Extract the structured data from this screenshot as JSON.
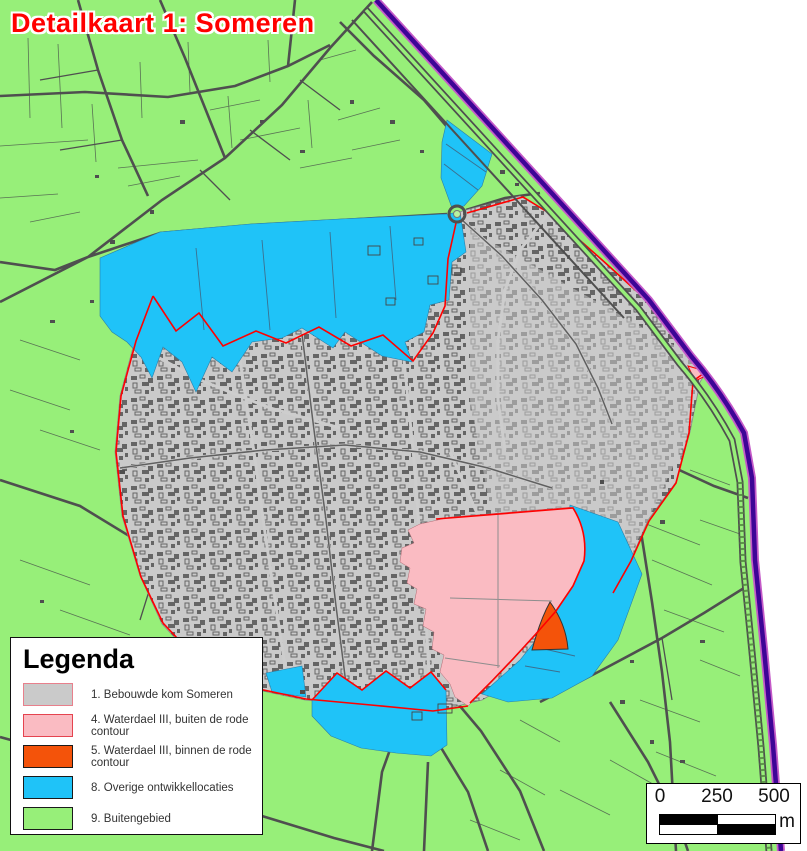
{
  "title": {
    "text": "Detailkaart 1: Someren",
    "color": "#FF0000"
  },
  "legend": {
    "title": "Legenda",
    "items": [
      {
        "label": "1. Bebouwde kom Someren",
        "color": "#CACACA",
        "border": "#E8808C"
      },
      {
        "label": "4. Waterdael III, buiten de rode contour",
        "color": "#FABBC2",
        "border": "#E5434F"
      },
      {
        "label": "5. Waterdael III, binnen de rode contour",
        "color": "#F4530A",
        "border": "#1A1A1A"
      },
      {
        "label": "8. Overige ontwikkellocaties",
        "color": "#1FC3F8",
        "border": "#1A1A1A"
      },
      {
        "label": "9. Buitengebied",
        "color": "#97EF79",
        "border": "#1A1A1A"
      }
    ]
  },
  "scalebar": {
    "ticks": [
      "0",
      "250",
      "500"
    ],
    "unit": "m"
  },
  "colors": {
    "buitengebied": "#97EF79",
    "bebouwde_kom": "#CACACA",
    "waterdael_buiten": "#FABBC2",
    "waterdael_binnen": "#F4530A",
    "ontwikkellocaties": "#1FC3F8",
    "rode_contour": "#FF0000",
    "gemeente_grens": "#3D0596",
    "grens_halo": "#C45AC8",
    "outside": "#FFFFFF",
    "road": "#4F4F4F"
  }
}
